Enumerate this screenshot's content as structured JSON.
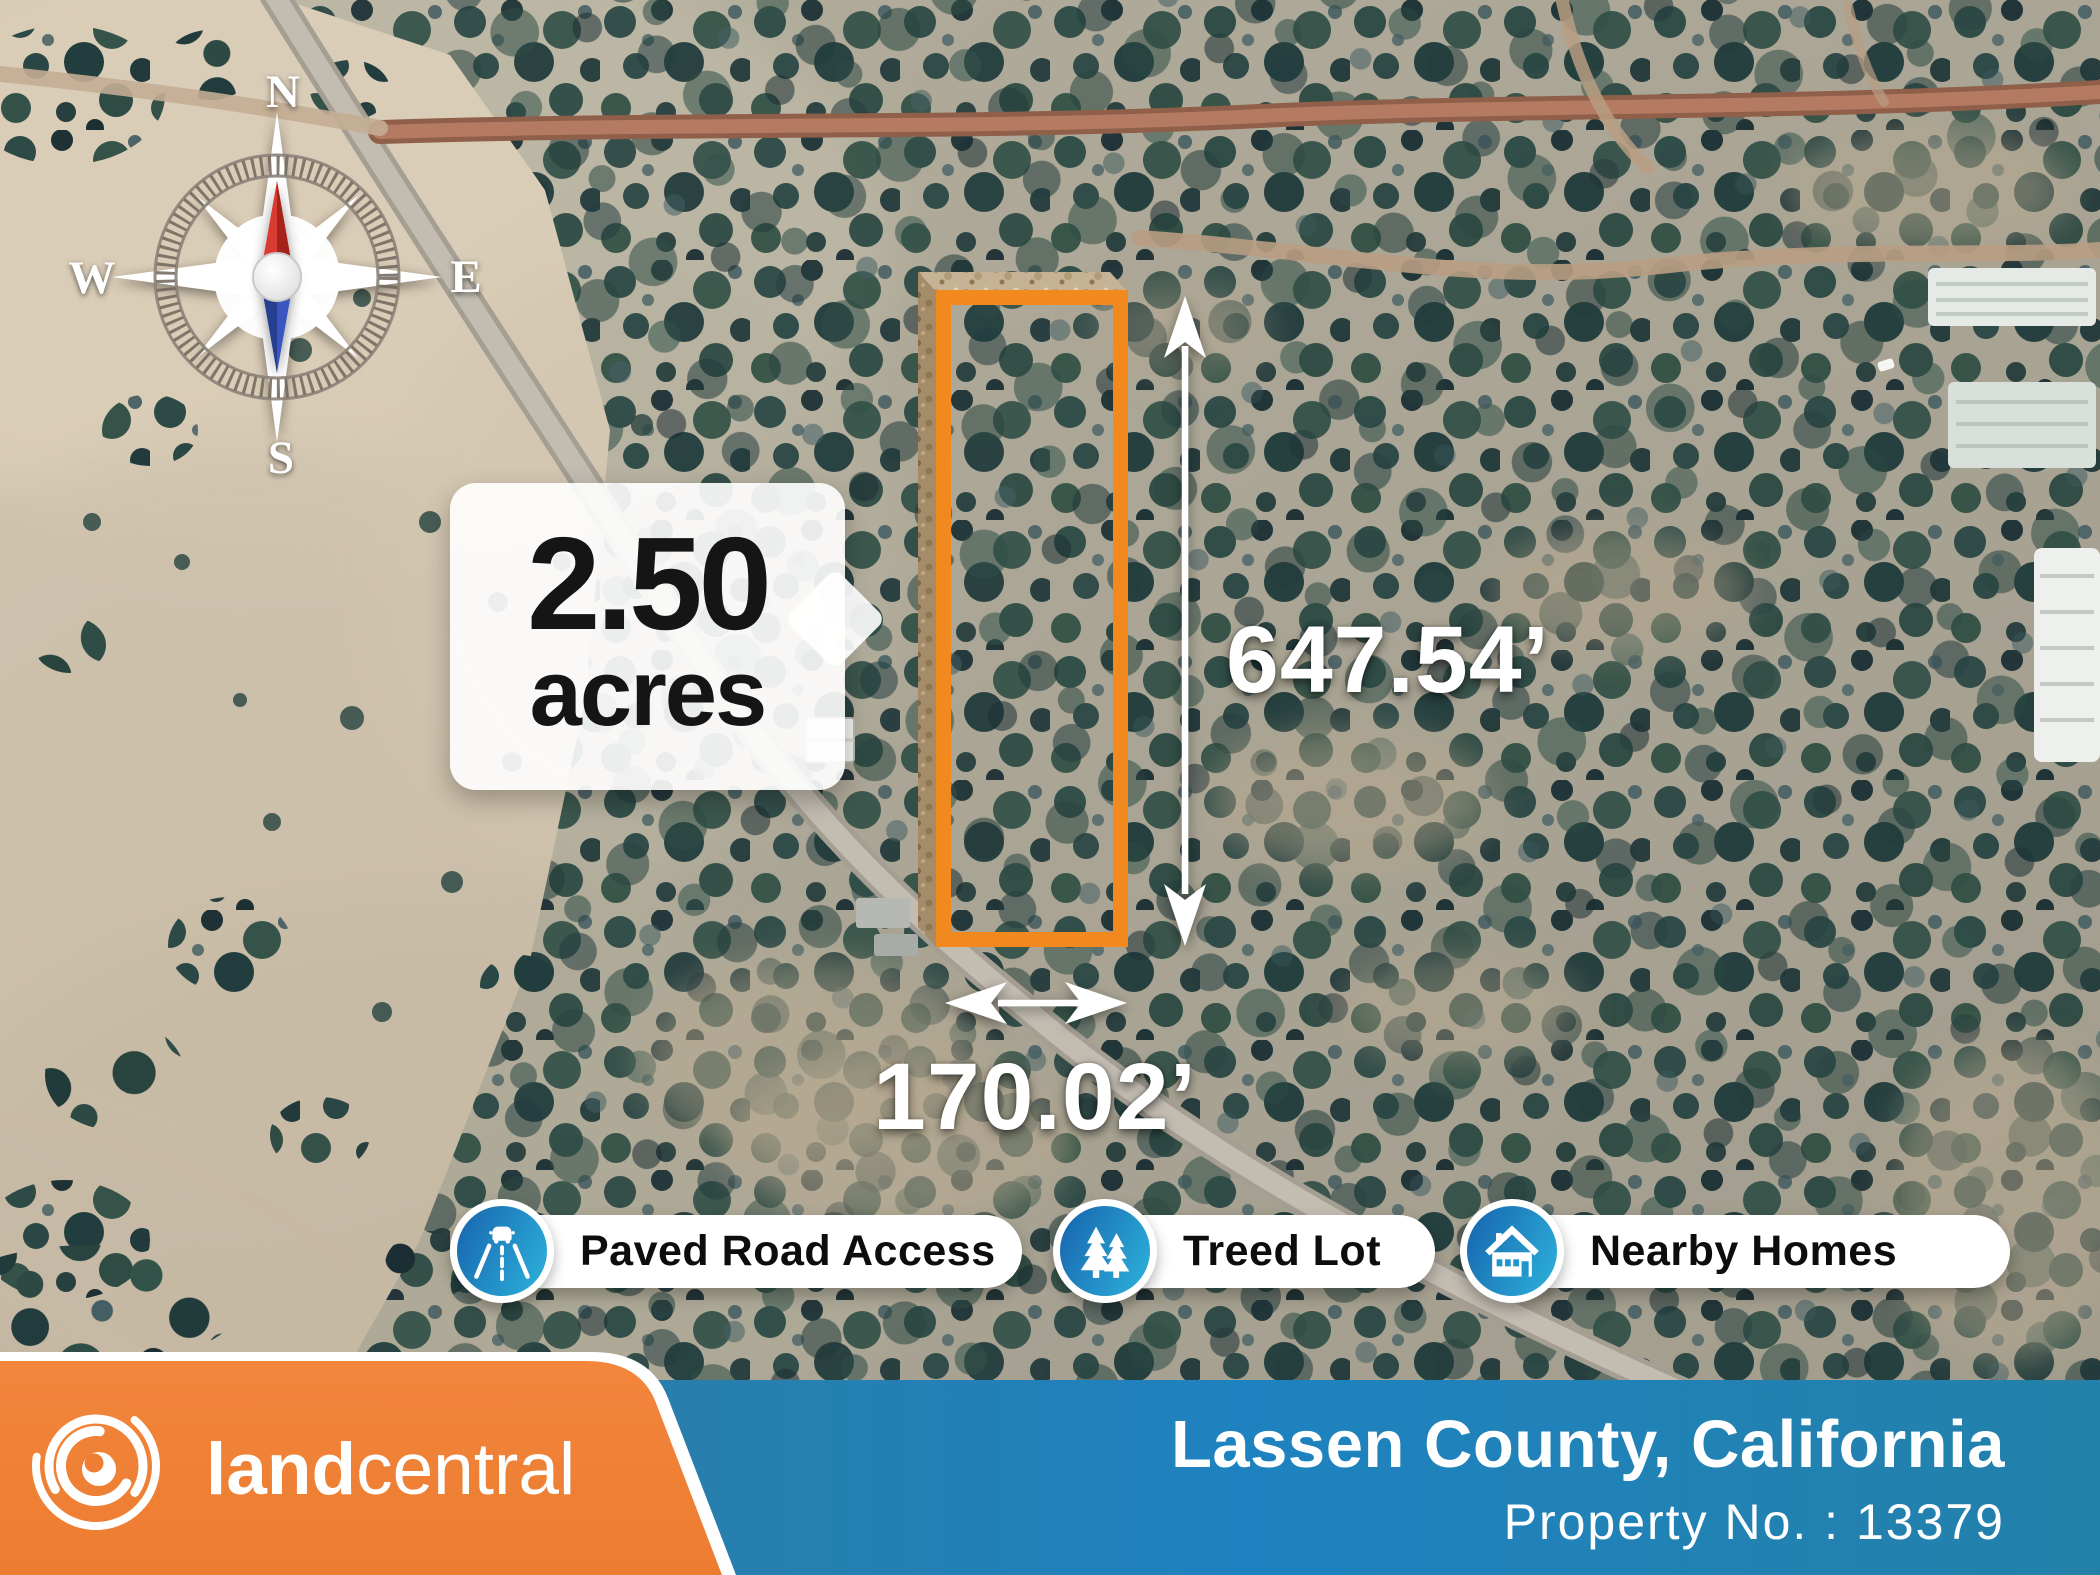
{
  "map": {
    "compass": {
      "north": "N",
      "east": "E",
      "south": "S",
      "west": "W"
    },
    "callout": {
      "value": "2.50",
      "unit": "acres"
    },
    "dimensions": {
      "height": "647.54’",
      "width": "170.02’"
    }
  },
  "badges": [
    {
      "label": "Paved Road Access",
      "icon": "paved-road-icon"
    },
    {
      "label": "Treed Lot",
      "icon": "pine-trees-icon"
    },
    {
      "label": "Nearby Homes",
      "icon": "house-icon"
    }
  ],
  "footer": {
    "brand": {
      "name_bold": "land",
      "name_light": "central"
    },
    "location": "Lassen County, California",
    "property_no": "Property No. : 13379"
  },
  "colors": {
    "banner_orange": "#EF8038",
    "banner_blue_left": "#2A7EA9",
    "banner_blue_right": "#2381A9",
    "parcel_outline_orange": "#F2891F",
    "badge_blue_dark": "#1A6FB4",
    "badge_blue_light": "#2AA7D5",
    "compass_needle_red": "#D6362B",
    "compass_needle_blue": "#3A57C0"
  }
}
